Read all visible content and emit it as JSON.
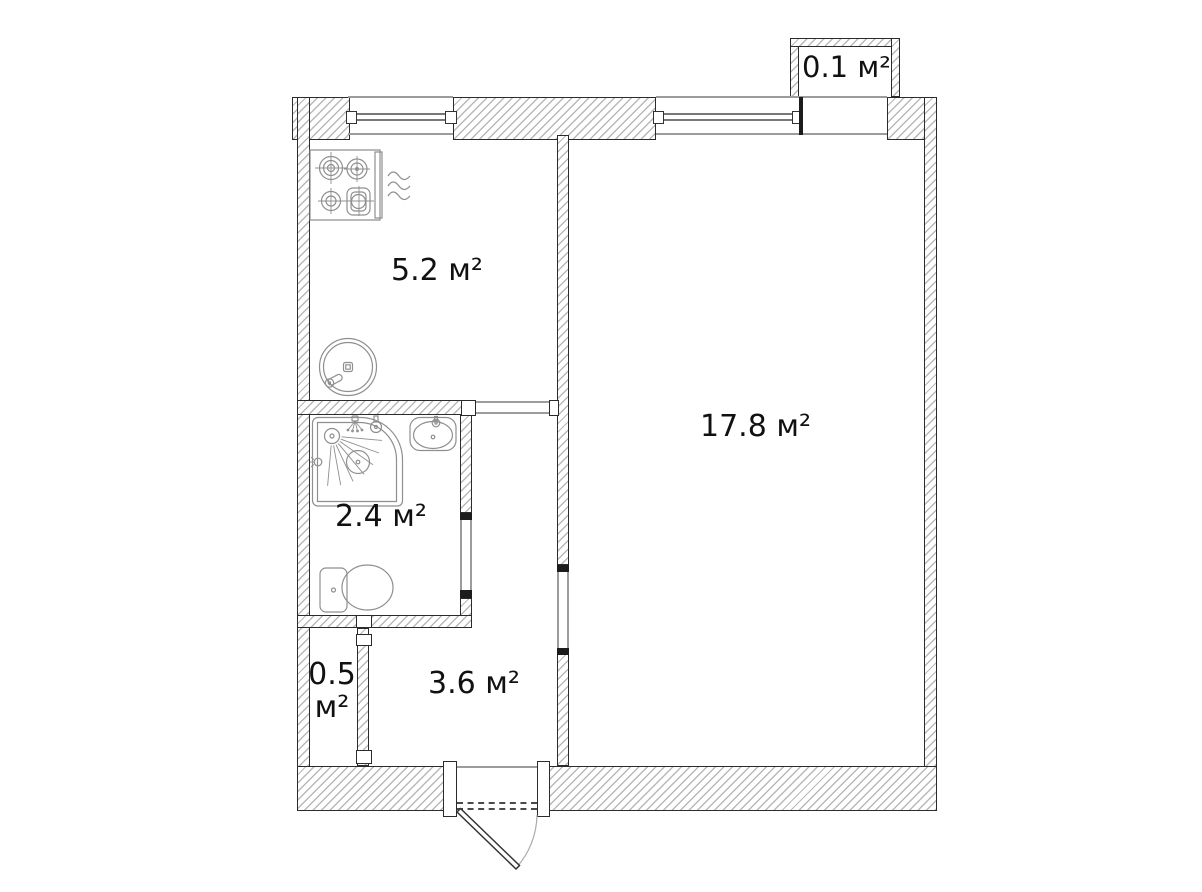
{
  "floor_plan": {
    "type": "apartment-floor-plan",
    "labels": {
      "kitchen": "5.2 м²",
      "living_room": "17.8 м²",
      "bathroom": "2.4 м²",
      "hallway": "3.6 м²",
      "closet_value": "0.5",
      "closet_unit": "м²",
      "balcony": "0.1 м²"
    },
    "fixtures": [
      "stove-icon",
      "kitchen-sink-icon",
      "shower-icon",
      "bathroom-sink-icon",
      "toilet-icon",
      "entry-door-icon",
      "kitchen-window-icon",
      "room-window-icon"
    ],
    "colors": {
      "background": "#ffffff",
      "wall_outline": "#2b2b2b",
      "wall_hatch": "#b9b9b9",
      "fixture_stroke": "#8f8f8f",
      "label_text": "#111111"
    }
  }
}
